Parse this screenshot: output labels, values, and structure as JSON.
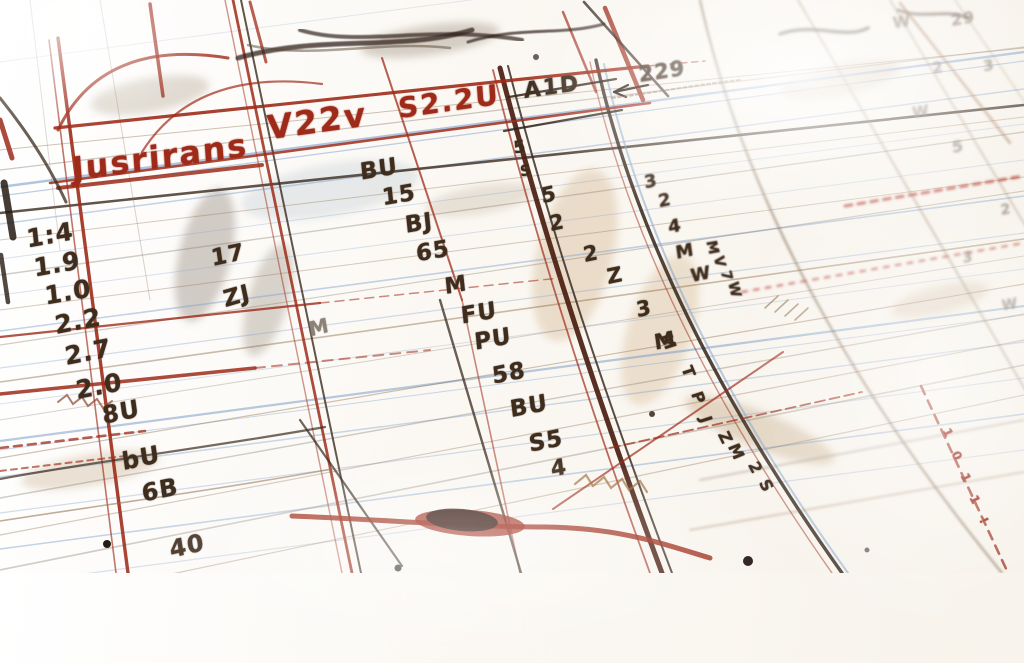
{
  "scene": {
    "description": "Close-up photo of a hand-drawn ledger sketch in red and sepia ink on ruled paper, shot at an angle with shallow depth of field",
    "palette": {
      "paper": "#faf8f4",
      "red": "#9e2b1a",
      "dark_red": "#6e1d10",
      "brown": "#3e2c1d",
      "sepia": "#8a6a48",
      "pencil": "#8d8276",
      "blue": "#7d9ec9",
      "tan": "#c8a06c"
    }
  },
  "title_row": {
    "cells": [
      "Jusrirans",
      "V22v",
      "S2.2U",
      "A1D"
    ],
    "arrow_label": "229"
  },
  "columns": {
    "left": [
      "1:4",
      "1.9",
      "1.0",
      "2.2",
      "2.7",
      "2.0",
      "8U",
      "bU",
      "6B",
      "40"
    ],
    "second": [
      "17",
      "ZJ",
      "M"
    ],
    "middle": [
      "BU",
      "15",
      "BJ",
      "65",
      "M",
      "FU",
      "PU",
      "58",
      "BU",
      "S5",
      "4"
    ],
    "diagonal_a": [
      "5",
      "2",
      "2",
      "Z",
      "3",
      "M"
    ],
    "diagonal_b": [
      "3",
      "2",
      "4",
      "M",
      "W"
    ],
    "along_line": [
      "M",
      "T",
      "P",
      "J",
      "Z",
      "M",
      "2",
      "S"
    ],
    "vertical_scribble": [
      "M",
      "V",
      "7",
      "W"
    ],
    "faint_right": [
      "W",
      "29",
      "2",
      "3",
      "W",
      "5",
      "2",
      "3",
      "W"
    ],
    "red_ticks": [
      "1",
      "0",
      "1",
      "1",
      "!"
    ]
  },
  "labels": [
    {
      "text": "Jusrirans",
      "x": 160,
      "y": 157,
      "rot": -8,
      "size": 32,
      "color": "red",
      "cls": "title"
    },
    {
      "text": "V22v",
      "x": 317,
      "y": 121,
      "rot": -8,
      "size": 33,
      "color": "red",
      "cls": "title"
    },
    {
      "text": "S2.2U",
      "x": 449,
      "y": 102,
      "rot": -8,
      "size": 28,
      "color": "red",
      "cls": "title"
    },
    {
      "text": "A1D",
      "x": 552,
      "y": 88,
      "rot": -8,
      "size": 22,
      "color": "brown",
      "cls": "title"
    },
    {
      "text": "229",
      "x": 662,
      "y": 72,
      "rot": -9,
      "size": 21,
      "color": "brown",
      "cls": "soft"
    },
    {
      "text": "5",
      "x": 520,
      "y": 148,
      "rot": -10,
      "size": 17,
      "color": "brown"
    },
    {
      "text": "S",
      "x": 526,
      "y": 171,
      "rot": -10,
      "size": 15,
      "color": "brown"
    },
    {
      "text": "1:4",
      "x": 50,
      "y": 235,
      "rot": -10,
      "size": 25,
      "color": "brown"
    },
    {
      "text": "1.9",
      "x": 57,
      "y": 264,
      "rot": -10,
      "size": 25,
      "color": "brown"
    },
    {
      "text": "1.0",
      "x": 68,
      "y": 292,
      "rot": -10,
      "size": 25,
      "color": "brown"
    },
    {
      "text": "2.2",
      "x": 78,
      "y": 321,
      "rot": -11,
      "size": 25,
      "color": "brown"
    },
    {
      "text": "2.7",
      "x": 88,
      "y": 352,
      "rot": -11,
      "size": 25,
      "color": "brown"
    },
    {
      "text": "2.0",
      "x": 99,
      "y": 386,
      "rot": -11,
      "size": 25,
      "color": "brown"
    },
    {
      "text": "8U",
      "x": 121,
      "y": 412,
      "rot": -12,
      "size": 24,
      "color": "brown"
    },
    {
      "text": "bU",
      "x": 141,
      "y": 458,
      "rot": -12,
      "size": 24,
      "color": "brown"
    },
    {
      "text": "6B",
      "x": 160,
      "y": 490,
      "rot": -12,
      "size": 24,
      "color": "brown"
    },
    {
      "text": "40",
      "x": 187,
      "y": 546,
      "rot": -13,
      "size": 24,
      "color": "brown"
    },
    {
      "text": "17",
      "x": 228,
      "y": 256,
      "rot": -12,
      "size": 23,
      "color": "brown"
    },
    {
      "text": "ZJ",
      "x": 237,
      "y": 297,
      "rot": -16,
      "size": 23,
      "color": "brown"
    },
    {
      "text": "M",
      "x": 319,
      "y": 327,
      "rot": -14,
      "size": 20,
      "color": "pencil"
    },
    {
      "text": "BU",
      "x": 379,
      "y": 170,
      "rot": -10,
      "size": 23,
      "color": "brown"
    },
    {
      "text": "15",
      "x": 399,
      "y": 196,
      "rot": -10,
      "size": 23,
      "color": "brown"
    },
    {
      "text": "BJ",
      "x": 419,
      "y": 224,
      "rot": -10,
      "size": 23,
      "color": "brown"
    },
    {
      "text": "65",
      "x": 433,
      "y": 252,
      "rot": -10,
      "size": 23,
      "color": "brown"
    },
    {
      "text": "M",
      "x": 456,
      "y": 286,
      "rot": -10,
      "size": 22,
      "color": "brown"
    },
    {
      "text": "FU",
      "x": 479,
      "y": 314,
      "rot": -10,
      "size": 23,
      "color": "brown"
    },
    {
      "text": "PU",
      "x": 493,
      "y": 340,
      "rot": -10,
      "size": 23,
      "color": "brown"
    },
    {
      "text": "58",
      "x": 509,
      "y": 374,
      "rot": -11,
      "size": 23,
      "color": "brown"
    },
    {
      "text": "BU",
      "x": 529,
      "y": 407,
      "rot": -11,
      "size": 23,
      "color": "brown"
    },
    {
      "text": "S5",
      "x": 546,
      "y": 442,
      "rot": -11,
      "size": 23,
      "color": "brown"
    },
    {
      "text": "4",
      "x": 559,
      "y": 469,
      "rot": -11,
      "size": 22,
      "color": "brown"
    },
    {
      "text": "5",
      "x": 549,
      "y": 195,
      "rot": -12,
      "size": 21,
      "color": "brown"
    },
    {
      "text": "2",
      "x": 557,
      "y": 223,
      "rot": -12,
      "size": 21,
      "color": "brown"
    },
    {
      "text": "2",
      "x": 591,
      "y": 254,
      "rot": -12,
      "size": 21,
      "color": "brown"
    },
    {
      "text": "Z",
      "x": 615,
      "y": 276,
      "rot": -12,
      "size": 21,
      "color": "brown"
    },
    {
      "text": "3",
      "x": 644,
      "y": 309,
      "rot": -12,
      "size": 21,
      "color": "brown"
    },
    {
      "text": "M",
      "x": 665,
      "y": 341,
      "rot": -12,
      "size": 21,
      "color": "brown"
    },
    {
      "text": "3",
      "x": 651,
      "y": 182,
      "rot": -12,
      "size": 18,
      "color": "brown",
      "cls": "soft"
    },
    {
      "text": "2",
      "x": 665,
      "y": 201,
      "rot": -12,
      "size": 18,
      "color": "brown",
      "cls": "soft"
    },
    {
      "text": "4",
      "x": 675,
      "y": 227,
      "rot": -12,
      "size": 18,
      "color": "brown",
      "cls": "soft"
    },
    {
      "text": "M",
      "x": 685,
      "y": 252,
      "rot": -12,
      "size": 18,
      "color": "brown",
      "cls": "soft"
    },
    {
      "text": "W",
      "x": 701,
      "y": 275,
      "rot": -12,
      "size": 18,
      "color": "brown",
      "cls": "soft"
    },
    {
      "text": "M",
      "x": 668,
      "y": 342,
      "rot": 68,
      "size": 16,
      "color": "brown"
    },
    {
      "text": "T",
      "x": 688,
      "y": 372,
      "rot": 68,
      "size": 16,
      "color": "brown"
    },
    {
      "text": "P",
      "x": 698,
      "y": 398,
      "rot": 68,
      "size": 16,
      "color": "brown"
    },
    {
      "text": "J",
      "x": 706,
      "y": 420,
      "rot": 68,
      "size": 16,
      "color": "brown"
    },
    {
      "text": "Z",
      "x": 725,
      "y": 438,
      "rot": 64,
      "size": 16,
      "color": "brown"
    },
    {
      "text": "M",
      "x": 736,
      "y": 452,
      "rot": 64,
      "size": 16,
      "color": "brown"
    },
    {
      "text": "2",
      "x": 755,
      "y": 468,
      "rot": 62,
      "size": 16,
      "color": "brown"
    },
    {
      "text": "S",
      "x": 766,
      "y": 486,
      "rot": 62,
      "size": 16,
      "color": "brown"
    },
    {
      "text": "M",
      "x": 712,
      "y": 248,
      "rot": 76,
      "size": 14,
      "color": "brown",
      "cls": "soft"
    },
    {
      "text": "V",
      "x": 719,
      "y": 262,
      "rot": 76,
      "size": 14,
      "color": "brown",
      "cls": "soft"
    },
    {
      "text": "7",
      "x": 726,
      "y": 276,
      "rot": 76,
      "size": 14,
      "color": "brown",
      "cls": "soft"
    },
    {
      "text": "W",
      "x": 734,
      "y": 290,
      "rot": 76,
      "size": 14,
      "color": "brown",
      "cls": "soft"
    },
    {
      "text": "W",
      "x": 902,
      "y": 22,
      "rot": -10,
      "size": 16,
      "color": "pencil",
      "cls": "far"
    },
    {
      "text": "29",
      "x": 963,
      "y": 19,
      "rot": -10,
      "size": 16,
      "color": "pencil",
      "cls": "far"
    },
    {
      "text": "2",
      "x": 938,
      "y": 68,
      "rot": -10,
      "size": 15,
      "color": "pencil",
      "cls": "far"
    },
    {
      "text": "3",
      "x": 989,
      "y": 66,
      "rot": -10,
      "size": 15,
      "color": "pencil",
      "cls": "far"
    },
    {
      "text": "W",
      "x": 921,
      "y": 112,
      "rot": -10,
      "size": 15,
      "color": "pencil",
      "cls": "far"
    },
    {
      "text": "5",
      "x": 958,
      "y": 147,
      "rot": -10,
      "size": 16,
      "color": "pencil",
      "cls": "far"
    },
    {
      "text": "2",
      "x": 1006,
      "y": 210,
      "rot": -10,
      "size": 14,
      "color": "pencil",
      "cls": "far"
    },
    {
      "text": "3",
      "x": 968,
      "y": 258,
      "rot": -10,
      "size": 14,
      "color": "pencil",
      "cls": "far"
    },
    {
      "text": "W",
      "x": 1010,
      "y": 305,
      "rot": -10,
      "size": 14,
      "color": "pencil",
      "cls": "far"
    },
    {
      "text": "1",
      "x": 948,
      "y": 433,
      "rot": 62,
      "size": 12,
      "color": "red"
    },
    {
      "text": "0",
      "x": 957,
      "y": 456,
      "rot": 62,
      "size": 12,
      "color": "red"
    },
    {
      "text": "1",
      "x": 966,
      "y": 478,
      "rot": 62,
      "size": 12,
      "color": "red"
    },
    {
      "text": "1",
      "x": 975,
      "y": 500,
      "rot": 62,
      "size": 12,
      "color": "red"
    },
    {
      "text": "!",
      "x": 984,
      "y": 521,
      "rot": 62,
      "size": 12,
      "color": "red"
    }
  ]
}
